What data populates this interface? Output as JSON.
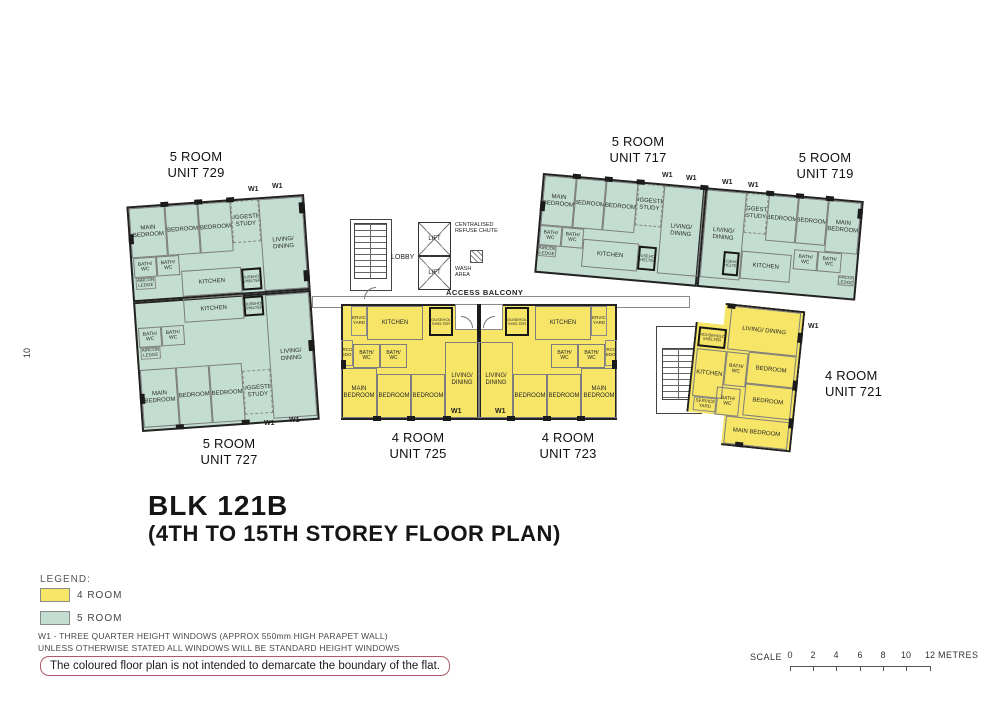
{
  "page_number": "10",
  "title": {
    "block": "BLK 121B",
    "storey": "(4TH TO 15TH STOREY FLOOR PLAN)"
  },
  "legend": {
    "heading": "LEGEND:",
    "items": [
      {
        "label": "4 ROOM",
        "color": "#f6e566"
      },
      {
        "label": "5 ROOM",
        "color": "#c3ded0"
      }
    ]
  },
  "notes": {
    "w1_note": "W1 - THREE QUARTER HEIGHT WINDOWS (APPROX 550mm HIGH PARAPET WALL)",
    "windows_note": "UNLESS OTHERWISE STATED ALL WINDOWS WILL BE STANDARD HEIGHT WINDOWS",
    "disclaimer": "The coloured floor plan is not intended to demarcate the boundary of the flat."
  },
  "scale": {
    "label": "SCALE",
    "ticks": [
      "0",
      "2",
      "4",
      "6",
      "8",
      "10",
      "12"
    ],
    "unit": "METRES"
  },
  "core": {
    "lobby": "LOBBY",
    "lift": "LIFT",
    "refuse_chute": "CENTRALISED REFUSE CHUTE",
    "wash_area": "WASH AREA",
    "access_balcony": "ACCESS BALCONY"
  },
  "window_marker": "W1",
  "rooms": {
    "main_bedroom": "MAIN BEDROOM",
    "bedroom": "BEDROOM",
    "living_dining": "LIVING/ DINING",
    "kitchen": "KITCHEN",
    "bath_wc": "BATH/ WC",
    "suggested_study": "SUGGESTED STUDY",
    "household_shelter": "HOUSEHOLD SHELTER",
    "service_yard": "SERVICE YARD",
    "aircon_ledge": "AIRCON LEDGE"
  },
  "units": [
    {
      "number": "729",
      "type": "5 ROOM",
      "label": "UNIT 729"
    },
    {
      "number": "717",
      "type": "5 ROOM",
      "label": "UNIT 717"
    },
    {
      "number": "719",
      "type": "5 ROOM",
      "label": "UNIT 719"
    },
    {
      "number": "727",
      "type": "5 ROOM",
      "label": "UNIT 727"
    },
    {
      "number": "725",
      "type": "4 ROOM",
      "label": "UNIT 725"
    },
    {
      "number": "723",
      "type": "4 ROOM",
      "label": "UNIT 723"
    },
    {
      "number": "721",
      "type": "4 ROOM",
      "label": "UNIT 721"
    }
  ],
  "colors": {
    "four_room": "#f6e566",
    "five_room": "#c3ded0",
    "wall": "#1b1b1b",
    "disclaimer_border": "#b05a6a"
  }
}
